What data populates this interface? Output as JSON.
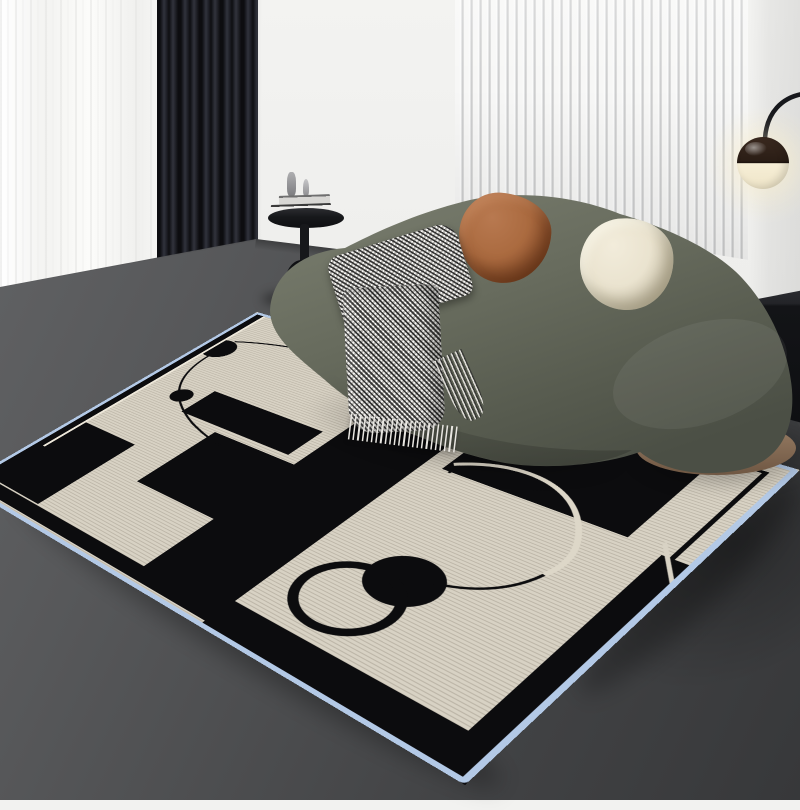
{
  "scene": {
    "setting": "modern minimalist living room product photo",
    "objects": [
      {
        "name": "sheer-curtain",
        "color": "#f7f7f5"
      },
      {
        "name": "blackout-curtain",
        "color": "#1c1d24"
      },
      {
        "name": "slat-accent-wall",
        "slat_color": "#f7f7f6",
        "gap_color": "#c7c8c9"
      },
      {
        "name": "arc-floor-lamp",
        "shade_top": "#3b2a20",
        "shade_bottom": "#f6eed6",
        "arm": "#17181c"
      },
      {
        "name": "curved-sofa",
        "upholstery": "#676b5d",
        "base_trim": "#8e7660"
      },
      {
        "name": "terracotta-pillow",
        "color": "#aa6a3f"
      },
      {
        "name": "cream-pillow",
        "color": "#eae3cf"
      },
      {
        "name": "houndstooth-throw",
        "light": "#eceae6",
        "dark": "#4a4a48",
        "detail": "fringed edge"
      },
      {
        "name": "black-side-table",
        "color": "#17181b",
        "items": [
          "stacked books",
          "small sculpture"
        ]
      },
      {
        "name": "black-console",
        "color": "#131417"
      },
      {
        "name": "area-rug",
        "field": "#d8d2c4",
        "pattern": "#0c0c0e",
        "binding": "#b3c9e6",
        "motifs": [
          "black rectangles",
          "black dots",
          "thin orbit curves",
          "arch ring",
          "white sweeping line",
          "black border bands"
        ]
      }
    ]
  },
  "palette": {
    "wall": "#f3f3f1",
    "curtainDark": "#1c1d24",
    "slatFace": "#f7f7f6",
    "slatGap": "#c7c8c9",
    "floorBack": "#57585a",
    "floorFront": "#37383a",
    "sofaLight": "#7b7f70",
    "sofaMid": "#676b5d",
    "sofaDark": "#4b4f45",
    "sofaBase": "#8e7660",
    "pillowRust": "#aa6a3f",
    "pillowRustDark": "#844a28",
    "pillowCream": "#eae3cf",
    "pillowCreamDark": "#c6bea6",
    "lampShadeTop": "#3b2a20",
    "lampShadeBottom": "#f6eed6",
    "lampArm": "#17181c",
    "tableBlack": "#17181b",
    "bookLight": "#efeeec",
    "bookGray": "#d8d7d4",
    "rugCream": "#d8d2c4",
    "rugBlack": "#0c0c0e",
    "rugSerge": "#b3c9e6",
    "rugLine": "#eee8da",
    "consoleBlack": "#131417"
  }
}
